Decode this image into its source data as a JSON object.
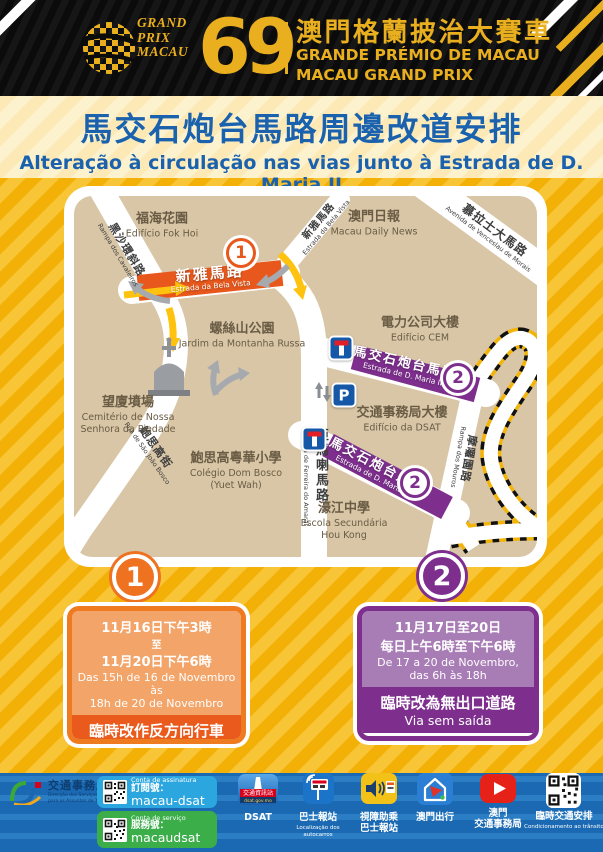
{
  "header": {
    "gp": [
      "GRAND",
      "PRIX",
      "MACAU"
    ],
    "edition": "69",
    "title_zh": "澳門格蘭披治大賽車",
    "title_pt": "GRANDE PRÉMIO DE MACAU",
    "title_en": "MACAU GRAND PRIX"
  },
  "banner": {
    "title_zh": "馬交石炮台馬路周邊改道安排",
    "subtitle_pt": "Alteração à circulação nas vias junto à Estrada de D. Maria II"
  },
  "map": {
    "roads": {
      "cavaleiros": {
        "zh": "黑沙環斜路",
        "pt": "Rampa dos Cavaleiros"
      },
      "bela_vista": {
        "zh": "新雅馬路",
        "pt": "Estrada da Bela Vista"
      },
      "morais": {
        "zh": "慕拉士大馬路",
        "pt": "Avenida de Venceslau de Morais"
      },
      "maria2": {
        "zh": "馬交石炮台馬路",
        "pt": "Estrada de D. Maria II"
      },
      "amaral": {
        "zh": "亞馬喇馬路",
        "pt": "Estrada de Ferreira do Amaral"
      },
      "bosco": {
        "zh": "鮑思高街",
        "pt": "Rua de São João Bosco"
      },
      "mouros": {
        "zh": "摩囉園路",
        "pt": "Rampa dos Mouros"
      }
    },
    "landmarks": {
      "fok_hoi": {
        "zh": "福海花園",
        "pt": "Edifício Fok Hoi"
      },
      "daily_news": {
        "zh": "澳門日報",
        "pt": "Macau Daily News"
      },
      "cem": {
        "zh": "電力公司大樓",
        "pt": "Edifício CEM"
      },
      "russa": {
        "zh": "螺絲山公園",
        "pt": "Jardim da Montanha Russa"
      },
      "dsat": {
        "zh": "交通事務局大樓",
        "pt": "Edifício da DSAT"
      },
      "cemetery": {
        "zh": "望廈墳場",
        "pt1": "Cemitério de Nossa",
        "pt2": "Senhora da Piedade"
      },
      "dom_bosco": {
        "zh": "鮑思高粵華小學",
        "pt1": "Colégio Dom Bosco",
        "pt2": "(Yuet Wah)"
      },
      "hou_kong": {
        "zh": "濠江中學",
        "pt1": "Escola Secundária",
        "pt2": "Hou Kong"
      }
    },
    "badges": {
      "one": "1",
      "two": "2"
    },
    "signs": {
      "parking": "P"
    }
  },
  "notice1": {
    "number": "1",
    "date1": "11月16日下午3時",
    "to": "至",
    "date2": "11月20日下午6時",
    "pt1": "Das 15h de 16 de Novembro às",
    "pt2": "18h de 20 de Novembro",
    "action_zh": "臨時改作反方向行車",
    "action_pt1": "Invertido o sentido da",
    "action_pt2": "circulação"
  },
  "notice2": {
    "number": "2",
    "date1": "11月17日至20日",
    "date2": "每日上午6時至下午6時",
    "pt1": "De 17 a 20 de Novembro,",
    "pt2": "das 6h às 18h",
    "action_zh": "臨時改為無出口道路",
    "action_pt": "Via sem saída"
  },
  "footer": {
    "agency": {
      "zh": "交通事務局",
      "pt1": "Direcção dos Serviços",
      "pt2": "para os Assuntos de Tráfego"
    },
    "subscribe": {
      "label": "Conta de assinatura",
      "zh": "訂閱號：",
      "account": "macau-dsat"
    },
    "service": {
      "label": "Conta de serviço",
      "zh": "服務號：",
      "account": "macaudsat"
    },
    "apps": {
      "dsat": {
        "icon_zh": "交通資訊站",
        "icon_sub": "dsat.gov.mo",
        "label": "DSAT"
      },
      "bus": {
        "label": "巴士報站",
        "sub1": "Localização dos",
        "sub2": "autocarros"
      },
      "assist": {
        "label1": "視障助乘",
        "label2": "巴士報站"
      },
      "travel": {
        "label": "澳門出行"
      },
      "youtube": {
        "label1": "澳門",
        "label2": "交通事務局"
      },
      "temp": {
        "label": "臨時交通安排",
        "sub": "Condicionamento ao trânsito"
      }
    }
  },
  "colors": {
    "gold": "#E9AF1E",
    "yellow_bg": "#F3B108",
    "orange": "#E8581C",
    "purple": "#7E2F8E",
    "blue_title": "#1A61AE",
    "footer_blue": "#1B69B2"
  }
}
